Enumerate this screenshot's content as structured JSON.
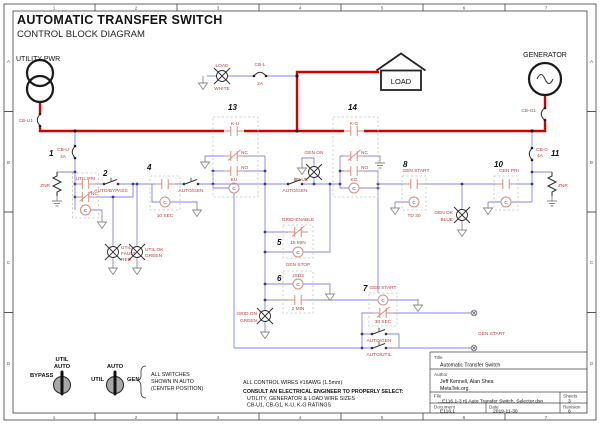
{
  "header": {
    "title": "AUTOMATIC TRANSFER SWITCH",
    "subtitle": "CONTROL BLOCK DIAGRAM"
  },
  "frame": {
    "cols": [
      "1",
      "2",
      "3",
      "4",
      "5",
      "6",
      "7"
    ],
    "rows": [
      "A",
      "B",
      "C",
      "D"
    ]
  },
  "power": {
    "utility": "UTILITY PWR",
    "generator": "GENERATOR",
    "load_house": "LOAD",
    "cb_u1": "CB-U1",
    "cb_g1": "CB-G1"
  },
  "top_branch": {
    "lamp_name": "LOAD",
    "lamp_color": "WHITE",
    "fuse_name": "CB-L",
    "fuse_rating": "2A"
  },
  "sections": {
    "s1": {
      "num": "1",
      "name": "CB-U",
      "rating": "4A"
    },
    "s2": {
      "num": "2",
      "label": "UTIL PRI",
      "nc": "NC"
    },
    "s4": {
      "num": "4",
      "timer": "10 SEC"
    },
    "s5": {
      "num": "5",
      "label": "GRID-ENABLE",
      "timer": "15 MIN"
    },
    "s6": {
      "num": "6",
      "label": "GEN STOP",
      "sublabel": "JSD3",
      "timer": "2 MIN"
    },
    "s7": {
      "num": "7",
      "label": "GEN START",
      "timer": "30 SEC"
    },
    "s8": {
      "num": "8",
      "label": "GEN START",
      "timer": "TD 30"
    },
    "s10": {
      "num": "10",
      "label": "GEN PRI"
    },
    "s11": {
      "num": "11",
      "name": "CB-G",
      "rating": "4A"
    },
    "s13": {
      "num": "13",
      "label": "K-U",
      "nc": "NC",
      "no": "NO",
      "coil": "KU"
    },
    "s14": {
      "num": "14",
      "label": "K-G",
      "nc": "NC",
      "no": "NO",
      "coil": "KG"
    }
  },
  "switches": {
    "auto_bypass": "AUTO/BYPASS",
    "auto_gen_1": "AUTO/GEN",
    "auto_gen_2": "AUTO/GEN",
    "auto_gen_3": "AUTO/GEN",
    "auto_util": "AUTO/UTIL"
  },
  "lamps": {
    "util_fault": {
      "l1": "UTIL",
      "l2": "FAULT",
      "color": "RED"
    },
    "util_ok": {
      "l1": "UTIL OK",
      "color": "GREEN"
    },
    "gen_on": {
      "l1": "GEN ON",
      "color": "BLUE"
    },
    "grid_on": {
      "l1": "GRID ON",
      "color": "GREEN"
    },
    "gen_ok": {
      "l1": "GEN OK",
      "color": "BLUE"
    }
  },
  "misc": {
    "znr_left": "ZNR",
    "znr_right": "ZNR",
    "gen_start_out": "GEN START",
    "coil_letter": "C"
  },
  "legend": {
    "bypass": "BYPASS",
    "a_top1": "UTIL",
    "a_top2": "AUTO",
    "b_left": "UTIL",
    "b_top": "AUTO",
    "b_right": "GEN",
    "n1": "ALL SWITCHES",
    "n2": "SHOWN IN AUTO",
    "n3": "(CENTER POSITION)"
  },
  "notes": {
    "n1": "ALL CONTROL WIRES #16AWG (1.5mm)",
    "n2": "CONSULT AN ELECTRICAL ENGINEER TO PROPERLY SELECT:",
    "n3": "UTILITY, GENERATOR & LOAD WIRE SIZES",
    "n4": "CB-U1, CB-G1, K-U, K-G RATINGS"
  },
  "titleblock": {
    "title_label": "Title",
    "title": "Automatic Transfer Switch",
    "author_label": "Author",
    "author": "Jeff Kennell, Alan Shea",
    "org": "MetaTek.org",
    "file_label": "File",
    "file": "...E116.1-3 r6 Auto Transfer Switch, Selector.dsn",
    "sheets_label": "Sheets",
    "sheets": "3",
    "document_label": "Document",
    "document": "E116.1",
    "date_label": "Date",
    "date": "2019-11-30",
    "revision_label": "Revision",
    "revision": "6"
  },
  "colors": {
    "power_wire": "#d40000",
    "control_wire": "#8484e6",
    "component": "#d98d80",
    "label_red": "#c43c3c"
  }
}
